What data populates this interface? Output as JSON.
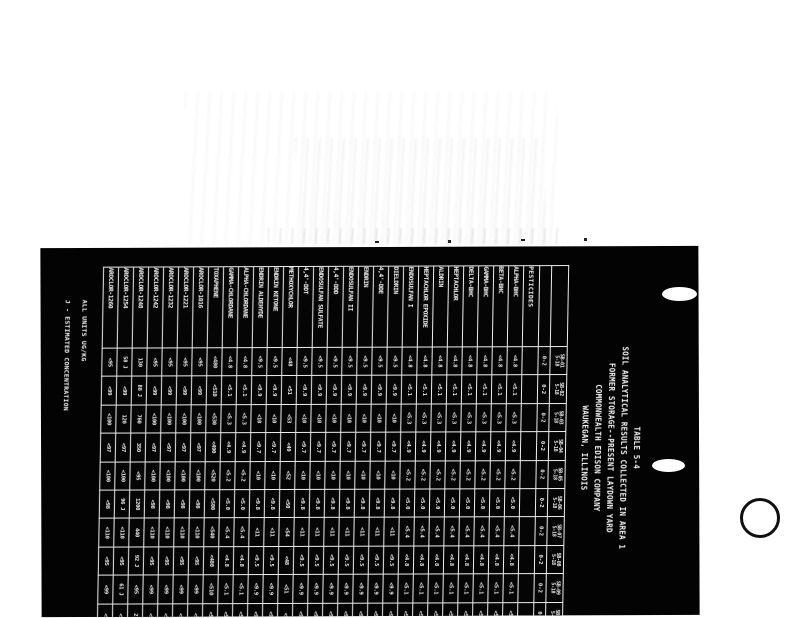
{
  "colors": {
    "sheet": "#030303",
    "ink": "#f4f4f4",
    "page": "#ffffff"
  },
  "title": {
    "lines": [
      "TABLE 5-4",
      "SOIL ANALYTICAL RESULTS COLLECTED IN AREA 1",
      "FORMER STORAGE--PRESENT LAYDOWN YARD",
      "COMMONWEALTH EDISON COMPANY",
      "WAUKEGAN, ILLINOIS"
    ]
  },
  "notes": {
    "line1": "ALL UNITS UG/KG",
    "line2": "J - ESTIMATED CONCENTRATION"
  },
  "table": {
    "section_label": "PESTICIDES",
    "samples": [
      {
        "id": "SB-01",
        "date": "5-18",
        "depth": "0-2"
      },
      {
        "id": "SB-02",
        "date": "5-18",
        "depth": "0-2"
      },
      {
        "id": "SB-03",
        "date": "5-18",
        "depth": "0-2"
      },
      {
        "id": "SB-04",
        "date": "5-18",
        "depth": "0-2"
      },
      {
        "id": "SB-05",
        "date": "5-18",
        "depth": "0-2"
      },
      {
        "id": "SB-06",
        "date": "5-18",
        "depth": "0-2"
      },
      {
        "id": "SB-07",
        "date": "5-18",
        "depth": "0-2"
      },
      {
        "id": "SB-08",
        "date": "5-18",
        "depth": "0-2"
      },
      {
        "id": "SB-09",
        "date": "5-18",
        "depth": "0-2"
      },
      {
        "id": "SB-10",
        "date": "5-18",
        "depth": "0-2"
      }
    ],
    "rows": [
      {
        "name": "ALPHA-BHC",
        "values": [
          "<4.8",
          "<5.1",
          "<5.3",
          "<4.9",
          "<5.2",
          "<5.0",
          "<5.4",
          "<4.8",
          "<5.1",
          "<5.0"
        ]
      },
      {
        "name": "BETA-BHC",
        "values": [
          "<4.8",
          "<5.1",
          "<5.3",
          "<4.9",
          "<5.2",
          "<5.0",
          "<5.4",
          "<4.8",
          "<5.1",
          "<5.0"
        ]
      },
      {
        "name": "GAMMA-BHC",
        "values": [
          "<4.8",
          "<5.1",
          "<5.3",
          "<4.9",
          "<5.2",
          "<5.0",
          "<5.4",
          "<4.8",
          "<5.1",
          "<5.0"
        ]
      },
      {
        "name": "DELTA-BHC",
        "values": [
          "<4.8",
          "<5.1",
          "<5.3",
          "<4.9",
          "<5.2",
          "<5.0",
          "<5.4",
          "<4.8",
          "<5.1",
          "<5.0"
        ]
      },
      {
        "name": "HEPTACHLOR",
        "values": [
          "<4.8",
          "<5.1",
          "<5.3",
          "<4.9",
          "<5.2",
          "<5.0",
          "<5.4",
          "<4.8",
          "<5.1",
          "<5.0"
        ]
      },
      {
        "name": "ALDRIN",
        "values": [
          "<4.8",
          "<5.1",
          "<5.3",
          "<4.9",
          "<5.2",
          "<5.0",
          "<5.4",
          "<4.8",
          "<5.1",
          "<5.0"
        ]
      },
      {
        "name": "HEPTACHLOR EPOXIDE",
        "values": [
          "<4.8",
          "<5.1",
          "<5.3",
          "<4.9",
          "<5.2",
          "<5.0",
          "<5.4",
          "<4.8",
          "<5.1",
          "<5.0"
        ]
      },
      {
        "name": "ENDOSULFAN I",
        "values": [
          "<4.8",
          "<5.1",
          "<5.3",
          "<4.9",
          "<5.2",
          "<5.0",
          "<5.4",
          "<4.8",
          "<5.1",
          "<5.0"
        ]
      },
      {
        "name": "DIELDRIN",
        "values": [
          "<9.5",
          "<9.9",
          "<10",
          "<9.7",
          "<10",
          "<9.8",
          "<11",
          "<9.5",
          "<9.9",
          "<9.7"
        ]
      },
      {
        "name": "4,4'-DDE",
        "values": [
          "<9.5",
          "<9.9",
          "<10",
          "<9.7",
          "<10",
          "<9.8",
          "<11",
          "<9.5",
          "<9.9",
          "<9.7"
        ]
      },
      {
        "name": "ENDRIN",
        "values": [
          "<9.5",
          "<9.9",
          "<10",
          "<9.7",
          "<10",
          "<9.8",
          "<11",
          "<9.5",
          "<9.9",
          "<9.7"
        ]
      },
      {
        "name": "ENDOSULFAN II",
        "values": [
          "<9.5",
          "<9.9",
          "<10",
          "<9.7",
          "<10",
          "<9.8",
          "<11",
          "<9.5",
          "<9.9",
          "<9.7"
        ]
      },
      {
        "name": "4,4'-DDD",
        "values": [
          "<9.5",
          "<9.9",
          "<10",
          "<9.7",
          "<10",
          "<9.8",
          "<11",
          "<9.5",
          "<9.9",
          "<9.7"
        ]
      },
      {
        "name": "ENDOSULFAN SULFATE",
        "values": [
          "<9.5",
          "<9.9",
          "<10",
          "<9.7",
          "<10",
          "<9.8",
          "<11",
          "<9.5",
          "<9.9",
          "<9.7"
        ]
      },
      {
        "name": "4,4'-DDT",
        "values": [
          "<9.5",
          "<9.9",
          "<10",
          "<9.7",
          "<10",
          "<9.8",
          "<11",
          "<9.5",
          "<9.9",
          "<9.7"
        ]
      },
      {
        "name": "METHOXYCHLOR",
        "values": [
          "<48",
          "<51",
          "<53",
          "<49",
          "<52",
          "<50",
          "<54",
          "<48",
          "<51",
          "<50"
        ]
      },
      {
        "name": "ENDRIN KETONE",
        "values": [
          "<9.5",
          "<9.9",
          "<10",
          "<9.7",
          "<10",
          "<9.8",
          "<11",
          "<9.5",
          "<9.9",
          "<9.7"
        ]
      },
      {
        "name": "ENDRIN ALDEHYDE",
        "values": [
          "<9.5",
          "<9.9",
          "<10",
          "<9.7",
          "<10",
          "<9.8",
          "<11",
          "<9.5",
          "<9.9",
          "<9.7"
        ]
      },
      {
        "name": "ALPHA-CHLORDANE",
        "values": [
          "<4.8",
          "<5.1",
          "<5.3",
          "<4.9",
          "<5.2",
          "<5.0",
          "<5.4",
          "<4.8",
          "<5.1",
          "<5.0"
        ]
      },
      {
        "name": "GAMMA-CHLORDANE",
        "values": [
          "<4.8",
          "<5.1",
          "<5.3",
          "<4.9",
          "<5.2",
          "<5.0",
          "<5.4",
          "<4.8",
          "<5.1",
          "<5.0"
        ]
      },
      {
        "name": "TOXAPHENE",
        "values": [
          "<480",
          "<510",
          "<530",
          "<490",
          "<520",
          "<500",
          "<540",
          "<480",
          "<510",
          "<500"
        ]
      },
      {
        "name": "AROCLOR-1016",
        "values": [
          "<95",
          "<99",
          "<100",
          "<97",
          "<100",
          "<98",
          "<110",
          "<95",
          "<99",
          "<97"
        ]
      },
      {
        "name": "AROCLOR-1221",
        "values": [
          "<95",
          "<99",
          "<100",
          "<97",
          "<100",
          "<98",
          "<110",
          "<95",
          "<99",
          "<97"
        ]
      },
      {
        "name": "AROCLOR-1232",
        "values": [
          "<95",
          "<99",
          "<100",
          "<97",
          "<100",
          "<98",
          "<110",
          "<95",
          "<99",
          "<97"
        ]
      },
      {
        "name": "AROCLOR-1242",
        "values": [
          "<95",
          "<99",
          "<100",
          "<97",
          "<100",
          "<98",
          "<110",
          "<95",
          "<99",
          "<97"
        ]
      },
      {
        "name": "AROCLOR-1248",
        "values": [
          "130",
          "88 J",
          "760",
          "350",
          "<95",
          "1200",
          "440",
          "92 J",
          "<95",
          "210"
        ]
      },
      {
        "name": "AROCLOR-1254",
        "values": [
          "58 J",
          "<99",
          "120",
          "<97",
          "<100",
          "96 J",
          "<110",
          "<95",
          "61 J",
          "<97"
        ]
      },
      {
        "name": "AROCLOR-1260",
        "values": [
          "<95",
          "<99",
          "<100",
          "<97",
          "<100",
          "<98",
          "<110",
          "<95",
          "<99",
          "<97"
        ]
      }
    ]
  }
}
